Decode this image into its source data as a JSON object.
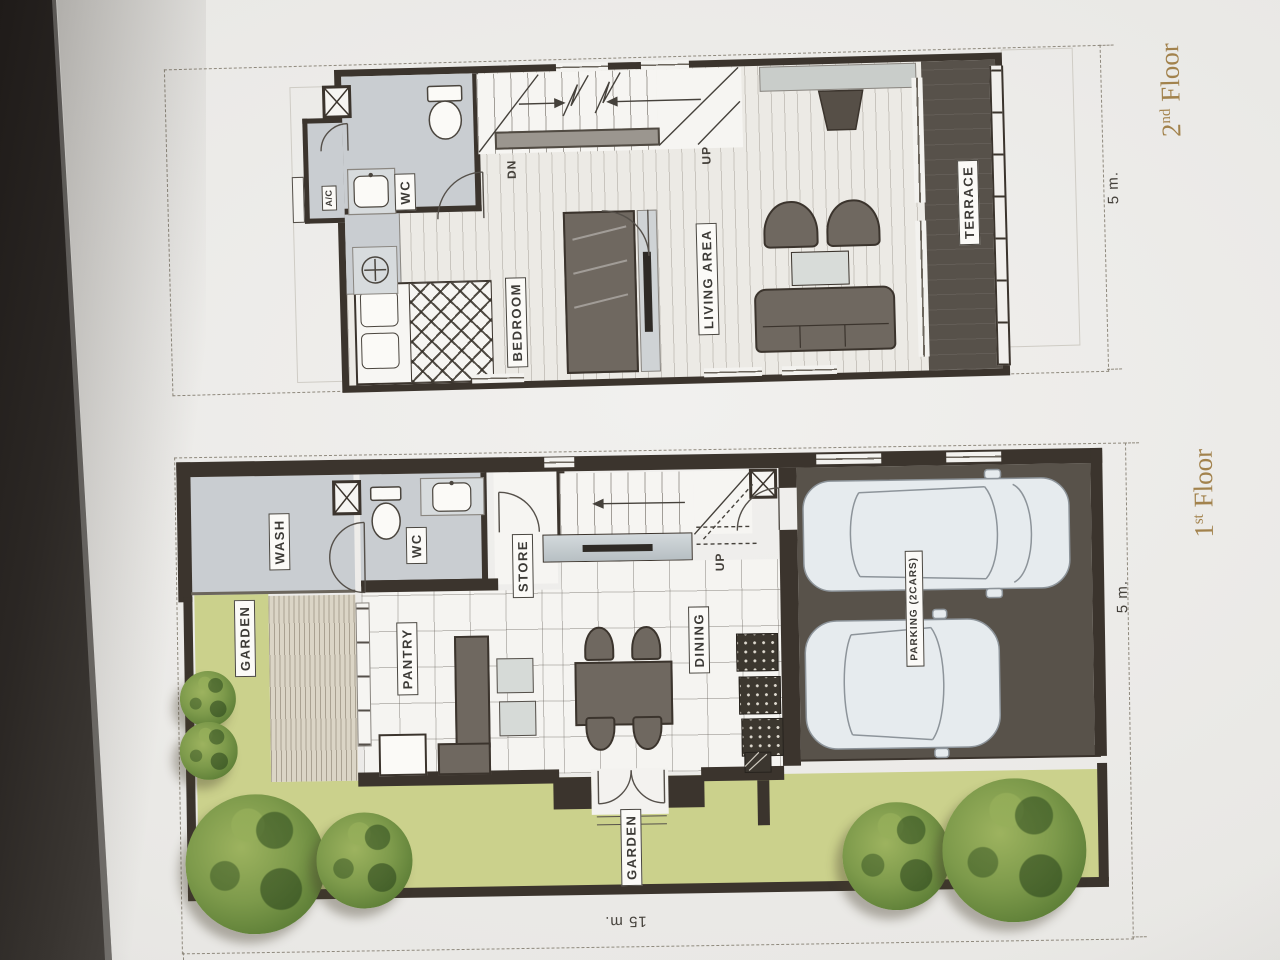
{
  "colors": {
    "wall": "#3b342d",
    "paper": "#e9e8e5",
    "room_gray": "#c9cdd1",
    "terrace": "#57514a",
    "parking": "#58524a",
    "garden": "#cbd18c",
    "tree": "#6f8f42",
    "furniture": "#6f6860",
    "accent_gold": "#a2824c"
  },
  "second_floor": {
    "title": {
      "number": "2",
      "ordinal": "nd",
      "word": "Floor"
    },
    "dim_width": "5 m.",
    "labels": {
      "ac": "A/C",
      "wc": "WC",
      "dn": "DN",
      "up": "UP",
      "bedroom": "BEDROOM",
      "living_area": "LIVING AREA",
      "terrace": "TERRACE"
    }
  },
  "first_floor": {
    "title": {
      "number": "1",
      "ordinal": "st",
      "word": "Floor"
    },
    "dim_width": "5 m.",
    "dim_length": "15 m.",
    "labels": {
      "wash": "WASH",
      "wc": "WC",
      "store": "STORE",
      "up": "UP",
      "pantry": "PANTRY",
      "dining": "DINING",
      "garden_side": "GARDEN",
      "garden_front": "GARDEN",
      "parking": "PARKING (2CARS)"
    }
  }
}
